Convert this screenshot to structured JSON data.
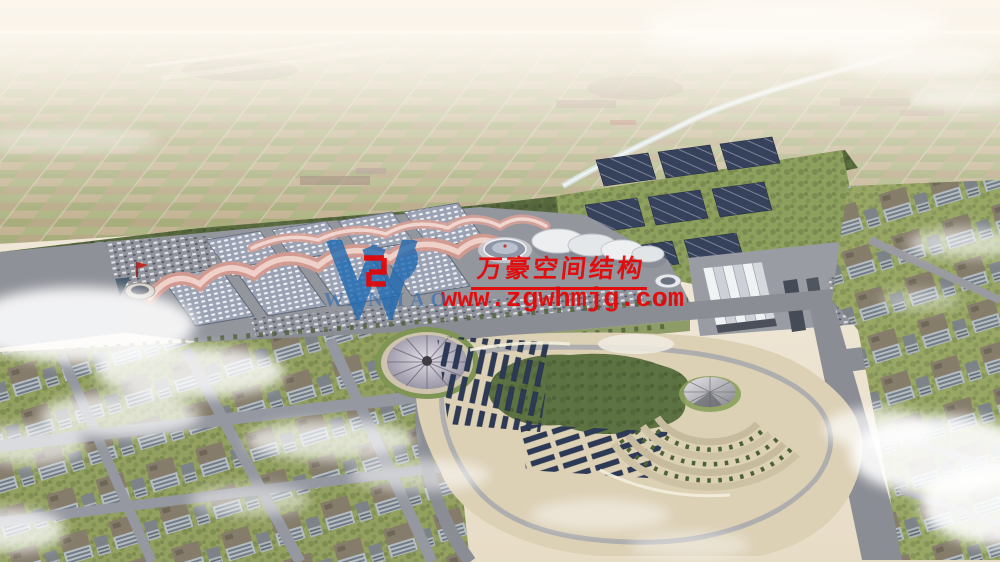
{
  "image": {
    "kind": "aerial architectural rendering",
    "subject": "exhibition-center campus with wave-canopy halls, circular park and city blocks under haze and clouds"
  },
  "watermark": {
    "logo_text": "WANHAO",
    "company_name": "万豪空间结构",
    "website": "www.zgwhmjg.com",
    "accent_red": "#e60404",
    "logo_blue": "#1f6ab2"
  },
  "palette": {
    "sky_haze": "#f4ede2",
    "farmland_tan": "#c6b894",
    "farmland_green": "#a8b07c",
    "tree_green": "#57683e",
    "hall_roof_gray": "#99a1b3",
    "canopy_pink": "#d49a8f",
    "road_gray": "#8b8d95",
    "park_ground": "#dcd0b5",
    "panel_navy": "#2e3c5e",
    "water_blue": "#cfdfe0",
    "cloud_white": "#ffffff"
  }
}
